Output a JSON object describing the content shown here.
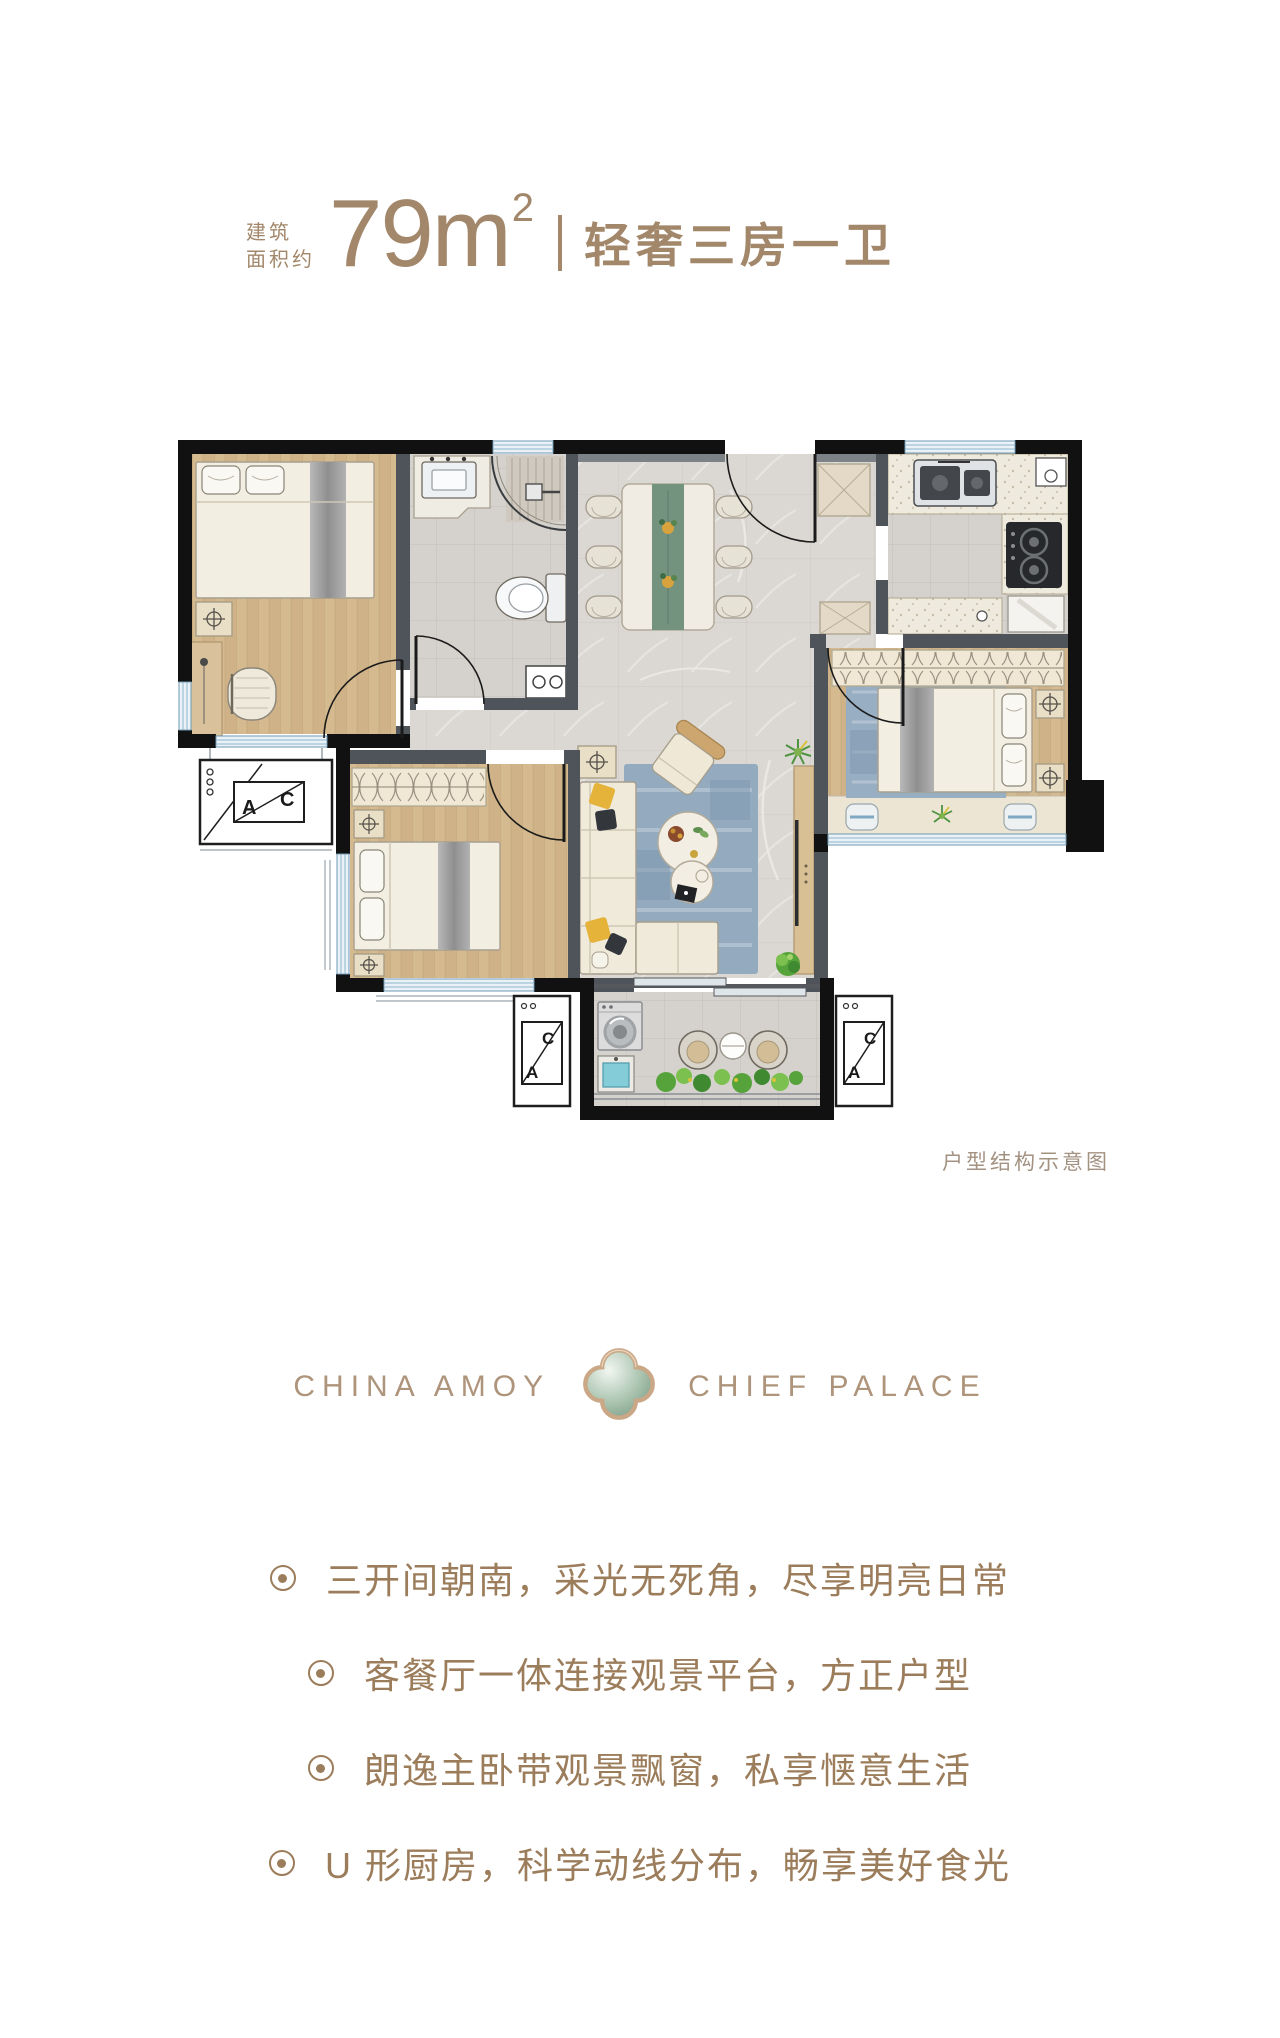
{
  "header": {
    "prefix_line1": "建筑",
    "prefix_line2": "面积约",
    "area_number": "79m",
    "area_exponent": "2",
    "tagline": "轻奢三房一卫"
  },
  "floorplan": {
    "caption": "户型结构示意图",
    "ac_letter_a": "A",
    "ac_letter_c": "C"
  },
  "logo": {
    "left": "CHINA AMOY",
    "right": "CHIEF PALACE",
    "emblem": "quatrefoil-icon"
  },
  "features": {
    "items": [
      "三开间朝南，采光无死角，尽享明亮日常",
      "客餐厅一体连接观景平台，方正户型",
      "朗逸主卧带观景飘窗，私享惬意生活",
      "U 形厨房，科学动线分布，畅享美好食光"
    ]
  },
  "colors": {
    "accent": "#a2876a",
    "feature_text": "#9c7d5b",
    "caption": "#a39282",
    "logo_text": "#ae947b",
    "wall": "#111111",
    "inner_wall": "#4e545a",
    "wood_floor": "#d3b78c",
    "marble_floor": "#dbd8d3",
    "rug_blue": "#93aabf",
    "window_blue": "#eaf2f8"
  }
}
